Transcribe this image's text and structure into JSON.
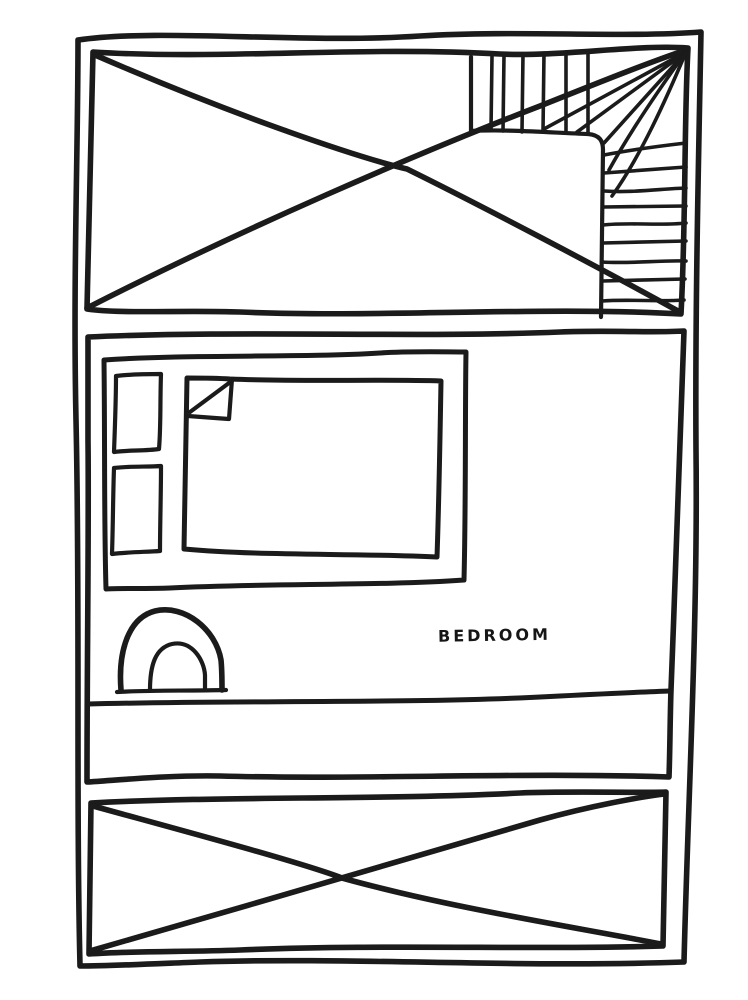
{
  "canvas": {
    "width": 748,
    "height": 1000,
    "background_color": "#ffffff",
    "ink_color": "#1b1b1b"
  },
  "floor_plan": {
    "style": "hand-drawn black ink floor plan sketch",
    "room_label": "BEDROOM",
    "sections": [
      {
        "name": "top-room",
        "label": "",
        "features": [
          "rectangle crossed out with large X",
          "L-shaped winder staircase in top-right corner"
        ]
      },
      {
        "name": "bedroom",
        "label": "BEDROOM",
        "features": [
          "double bed with two pillows",
          "duvet with folded-back corner",
          "arched door swing at bottom-left wall"
        ]
      },
      {
        "name": "hallway-strip",
        "label": "",
        "features": [
          "empty horizontal corridor band below bedroom"
        ]
      },
      {
        "name": "bottom-room",
        "label": "",
        "features": [
          "rectangle crossed out with large X"
        ]
      }
    ],
    "staircase": {
      "upper_flight_treads": 6,
      "winder_fan_lines": 5,
      "side_flight_treads": 9
    },
    "furniture": {
      "bed": {
        "pillows": 2,
        "duvet_folded_corner": true
      },
      "door_swing_arches": 2
    }
  }
}
